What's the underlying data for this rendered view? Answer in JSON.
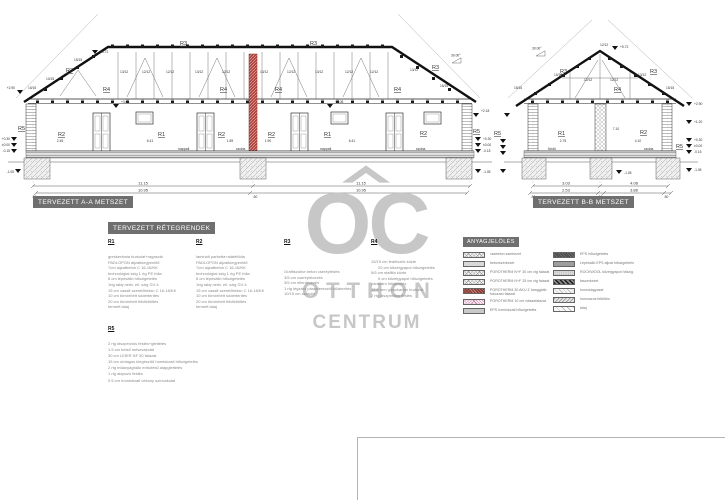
{
  "watermark": {
    "letters": "OC",
    "otthon": "OTTHON",
    "centrum": "CENTRUM"
  },
  "marks": {
    "r1": "R1",
    "r2": "R2",
    "r3": "R3",
    "r4": "R4",
    "r5": "R5",
    "p1515": "15/15",
    "p1212": "12/12",
    "p1312": "13/12",
    "p1015": "10/15"
  },
  "section_a": {
    "title": "TERVEZETT A-A METSZET",
    "angle": "30.00°",
    "dim_total": "11.15",
    "dim_inner": "10.95",
    "dim_end": ".50",
    "d245": "2.45",
    "d641": "6.41",
    "d189": "1.89",
    "d190": "1.90",
    "room1": "nappali",
    "room2": "szoba",
    "e572": "+5.72",
    "e290": "+2.90",
    "e308": "+3.08",
    "e218": "+2.18",
    "e030": "+0.30",
    "e000": "±0.00",
    "e015": "-0.15",
    "e105": "-1.05"
  },
  "section_b": {
    "title": "TERVEZETT B-B METSZET",
    "angle": "30.00°",
    "t1": "3.03",
    "t2": "4.08",
    "b1": "2.53",
    "b2": "3.88",
    "half": ".50",
    "d275": "2.75",
    "d710": "7.10",
    "d410": "4.10",
    "room1": "fürdő",
    "room2": "szoba",
    "e572": "+5.72",
    "e290": "+2.90",
    "e120": "+1.20",
    "e030": "+0.30",
    "e000": "±0.00",
    "e015": "-0.15",
    "e105": "-1.05"
  },
  "layers": {
    "title": "TERVEZETT RÉTEGRENDEK",
    "r1": {
      "id": "R1",
      "lines": [
        "greskerámia burkolat+ragasztó",
        "PADLOPON aljzatkiegyenlítő",
        "7cm aljzatbeton C 16-16/KK",
        "technológiai szig 1 rtg PE fólia",
        "8 cm lépésálló hőszigetelés",
        "1rtg talaj nedv. ell. szig GV-4",
        "15 cm vasalt szerelőbeton C 16-16/KK",
        "10 cm tömörített sóderterítés",
        "20 cm tömörített földfeltöltés",
        "termett talaj"
      ]
    },
    "r2": {
      "id": "R2",
      "lines": [
        "laminált parketta+alátétfólia",
        "PADLOPON aljzatkiegyenlítő",
        "7cm aljzatbeton C 16-16/KK",
        "technológiai szig 1 rtg PE fólia",
        "8 cm lépésálló hőszigetelés",
        "1rtg talaj nedv. ell. szig GV-4",
        "15 cm vasalt szerelőbeton C 16-16/KK",
        "10 cm tömörített sóderterítés",
        "20 cm tömörített földfeltöltés",
        "termett talaj"
      ]
    },
    "r3": {
      "id": "R3",
      "lines": [
        "Grafitszürke beton cserépfedés",
        "3/5 cm cseréplécezés",
        "3/5 cm ellenlécezés",
        "1 rtg légzáró páraáteresztő fóliaterítés",
        "10/15 cm szarufa"
      ]
    },
    "r4": {
      "id": "R4",
      "lines": [
        "15/15 cm fedélszék közte",
        "20 cm kőzetgyapot hőszigetelés",
        "5/5 cm staflifa közte",
        "5 cm kőzetgyapot hőszigetelés",
        "párazáró fóliaterítés",
        "12.5 mm gipszkarton burkolat",
        "2 rtg diszperziós festés"
      ]
    },
    "r5": {
      "id": "R5",
      "lines": [
        "2 rtg diszperziós festés+glettelés",
        "1.5 cm belső mészvakolat",
        "30 cm LEIER NF 30 falazat",
        "15 cm utólagos kiegészítő homlokzati hőszigetelés",
        "2 rtg műanyagháló erősítésű alapglettelés",
        "1 rtg alapozó festés",
        "0.5 cm homlokzati vékony színvakolat"
      ]
    }
  },
  "materials": {
    "title": "ANYAGJELÖLÉS",
    "left": [
      {
        "label": "vasbeton szerkezet"
      },
      {
        "label": "betonszerkezet"
      },
      {
        "label": "POROTHERM N+F 30 cm vtg falazat"
      },
      {
        "label": "POROTHERM N+F 25 cm vtg falazat"
      },
      {
        "label": "POROTHERM 30 AKU Z hanggátló fokozatú falazat"
      },
      {
        "label": "POROTHERM 10 cm válaszfalazat"
      },
      {
        "label": "EPS homlokzati hőszigetelés"
      }
    ],
    "right": [
      {
        "label": "EPS hőszigetelés"
      },
      {
        "label": "Lépésálló EPS aljzat hőszigetelés"
      },
      {
        "label": "ROCKWOOL kőzetgyapot hőszig."
      },
      {
        "label": "faszerkezet"
      },
      {
        "label": "homokágyazat"
      },
      {
        "label": "humuszos feltöltés"
      },
      {
        "label": "talaj"
      }
    ]
  }
}
